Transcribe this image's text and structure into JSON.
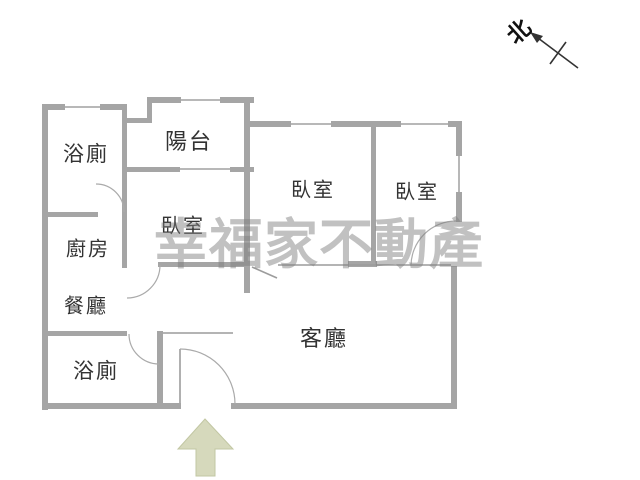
{
  "plan": {
    "title": "apartment-floor-plan",
    "rooms": [
      {
        "id": "bathroom-top",
        "label": "浴廁"
      },
      {
        "id": "balcony",
        "label": "陽台"
      },
      {
        "id": "bedroom-middle",
        "label": "臥室"
      },
      {
        "id": "bedroom-top",
        "label": "臥室"
      },
      {
        "id": "bedroom-right",
        "label": "臥室"
      },
      {
        "id": "kitchen",
        "label": "廚房"
      },
      {
        "id": "dining",
        "label": "餐廳"
      },
      {
        "id": "bathroom-bottom",
        "label": "浴廁"
      },
      {
        "id": "living",
        "label": "客廳"
      }
    ]
  },
  "watermark": {
    "text": "幸福家不動產"
  },
  "north": {
    "label": "北"
  },
  "colors": {
    "wall": "#a5a5a5",
    "window_line": "#b8b8b8",
    "door_arc": "#aaaaaa",
    "entrance_arrow_fill": "#d6d9bc",
    "entrance_arrow_stroke": "#c2c7a3",
    "watermark_gray": "#9e9e9e",
    "label_text": "#333333",
    "north_arrow": "#333333"
  }
}
